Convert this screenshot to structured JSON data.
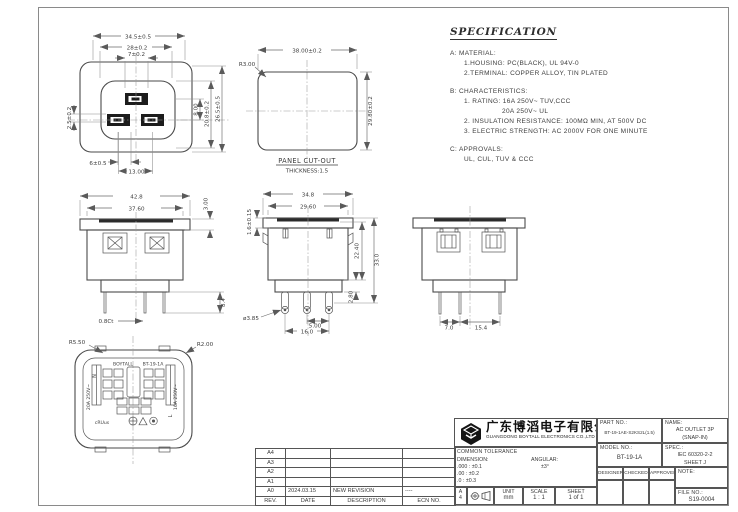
{
  "spec": {
    "title": "SPECIFICATION",
    "a_label": "A: MATERIAL:",
    "a1": "1.HOUSING: PC(BLACK), UL 94V-0",
    "a2": "2.TERMINAL: COPPER ALLOY, TIN PLATED",
    "b_label": "B: CHARACTERISTICS:",
    "b1": "1. RATING: 16A 250V~ TUV,CCC",
    "b1b": "20A 250V~ UL",
    "b2": "2. INSULATION RESISTANCE: 100MΩ MIN, AT 500V DC",
    "b3": "3. ELECTRIC STRENGTH: AC 2000V FOR ONE MINUTE",
    "c_label": "C: APPROVALS:",
    "c1": "UL, CUL, TUV & CCC"
  },
  "views": {
    "front": {
      "dim_w_outer": "34.5±0.5",
      "dim_w_mid": "28±0.2",
      "dim_w_slot": "7±0.2",
      "dim_h_slot": "8.00",
      "dim_h_mid": "20.8±0.2",
      "dim_h_outer": "26.5±0.5",
      "dim_left": "2.5±0.2",
      "dim_b_small": "6±0.5",
      "dim_b_pitch": "13.00"
    },
    "panel": {
      "dim_w": "38.00±0.2",
      "radius": "R3.00",
      "dim_h": "29.80±0.2",
      "caption": "PANEL CUT-OUT",
      "thickness": "THICKNESS:1.5"
    },
    "top": {
      "dim_w_flange": "42.8",
      "dim_w_body": "37.60",
      "dim_flange_t": "3.00",
      "dim_pin_len": "8.4",
      "dim_pin_t": "0.8Ct"
    },
    "side": {
      "dim_w_flange": "34.8",
      "dim_w_body": "29.60",
      "dim_flange_t": "1.6±0.15",
      "dim_h_body": "22.40",
      "dim_h_total": "33.0",
      "dim_step": "2.80",
      "pin_dia": "ø3.85",
      "dim_pin_a": "5.00",
      "dim_pin_b": "16.0"
    },
    "right": {
      "dim_pin_a": "7.0",
      "dim_pin_b": "15.4"
    },
    "rear": {
      "radius_outer": "R5.50",
      "radius_corner": "R2.00",
      "brand": "BOYTALL",
      "model": "BT-19-1A",
      "neutral": "N",
      "live": "L",
      "rating_left": "20A 250V~",
      "rating_right": "16A 250V~",
      "ul_mark": "cRUus"
    }
  },
  "revisions": {
    "headers": {
      "rev": "REV.",
      "date": "DATE",
      "desc": "DESCRIPTION",
      "ecn": "ECN NO."
    },
    "rows": [
      {
        "rev": "A4",
        "date": "",
        "desc": "",
        "ecn": ""
      },
      {
        "rev": "A3",
        "date": "",
        "desc": "",
        "ecn": ""
      },
      {
        "rev": "A2",
        "date": "",
        "desc": "",
        "ecn": ""
      },
      {
        "rev": "A1",
        "date": "",
        "desc": "",
        "ecn": ""
      },
      {
        "rev": "A0",
        "date": "2024.03.15",
        "desc": "NEW REVISION",
        "ecn": "----"
      }
    ]
  },
  "titleblock": {
    "company_cn": "广东博滔电子有限公司",
    "company_en": "GUANGDONG BOYTALL ELECTRONICS CO.,LTD",
    "part_no_label": "PART NO.:",
    "part_no": "BT-19-1AE-S2KS2L(1.5)",
    "name_label": "NAME:",
    "name1": "AC OUTLET 3P",
    "name2": "(SNAP-IN)",
    "model_label": "MODEL NO.:",
    "model_no": "BT-19-1A",
    "spec_label": "SPEC.:",
    "spec1": "IEC 60320-2-2",
    "spec2": "SHEET J",
    "tol_header": "COMMON TOLERANCE",
    "tol_dim_label": "DIMENSION:",
    "tol_ang_label": "ANGULAR:",
    "tol_r1": ".000 : ±0.1",
    "tol_r2": ".00 : ±0.2",
    "tol_r3": ".0 : ±0.3",
    "tol_ang_val": "±3°",
    "designer": "DESIGNER",
    "checked": "CHECKED",
    "approved": "APPROVED",
    "note_label": "NOTE:",
    "file_label": "FILE NO.:",
    "file_no": "S19-0004",
    "unit_label": "UNIT",
    "unit": "mm",
    "scale_label": "SCALE",
    "scale": "1 : 1",
    "sheet_label": "SHEET",
    "sheet": "1 of 1",
    "size_a": "A",
    "size_4": "4"
  }
}
